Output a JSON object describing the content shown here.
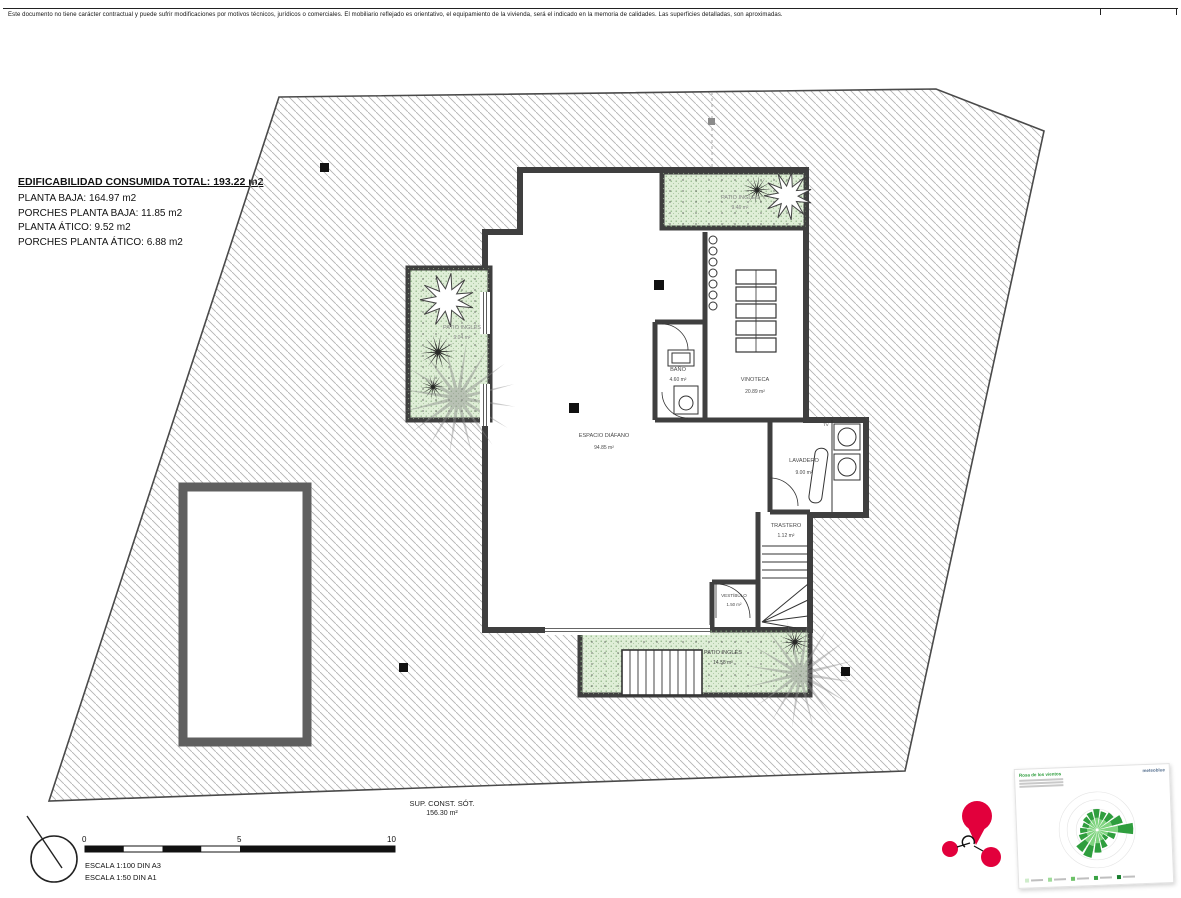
{
  "disclaimer": "Este documento no tiene carácter contractual y puede sufrir modificaciones por motivos técnicos, jurídicos o comerciales. El mobiliario reflejado es orientativo, el equipamiento de la vivienda, será el indicado en la memoria de calidades. Las superficies detalladas, son aproximadas.",
  "summary": {
    "title": "EDIFICABILIDAD CONSUMIDA TOTAL: 193.22 m2",
    "lines": [
      "PLANTA BAJA: 164.97 m2",
      "PORCHES PLANTA BAJA: 11.85 m2",
      "PLANTA ÁTICO: 9.52 m2",
      "PORCHES PLANTA ÁTICO: 6.88 m2"
    ]
  },
  "rooms": {
    "espacio": {
      "name": "ESPACIO DIÁFANO",
      "area": "94.85 m²"
    },
    "bano": {
      "name": "BAÑO",
      "area": "4.60 m²"
    },
    "vinoteca": {
      "name": "VINOTECA",
      "area": "20.89 m²"
    },
    "lavadero": {
      "name": "LAVADERO",
      "area": "9.00 m²"
    },
    "trastero": {
      "name": "TRASTERO",
      "area": "1.12 m²"
    },
    "vestibulo": {
      "name": "VESTÍBULO",
      "area": "1.50 m²"
    },
    "patio_top": {
      "name": "PATIO INGLÉS",
      "area": "9.46 m²"
    },
    "patio_left": {
      "name": "PATIO INGLÉS",
      "area": "9.04 m²"
    },
    "patio_bottom": {
      "name": "PATIO INGLÉS",
      "area": "14.58 m²"
    },
    "tv": "TV"
  },
  "floor": {
    "title": "SUP. CONST. SÓT.",
    "area": "156.30 m²"
  },
  "scalebar": {
    "tick0": "0",
    "tick5": "5",
    "tick10": "10",
    "line1": "ESCALA 1:100 DIN A3",
    "line2": "ESCALA 1:50 DIN A1"
  },
  "windrose": {
    "title": "Rosa de los vientos",
    "brand": "meteoblue",
    "sectors": [
      0.55,
      0.5,
      0.55,
      0.7,
      0.95,
      0.5,
      0.35,
      0.5,
      0.6,
      0.75,
      0.7,
      0.5,
      0.45,
      0.4,
      0.45,
      0.5
    ],
    "color_light": "#7fd47f",
    "color_dark": "#2f9e3e"
  },
  "colors": {
    "wall": "#3f3f3f",
    "hatch": "#b4b4b4",
    "patio_fill": "#dfeed7",
    "red": "#e2003c"
  }
}
